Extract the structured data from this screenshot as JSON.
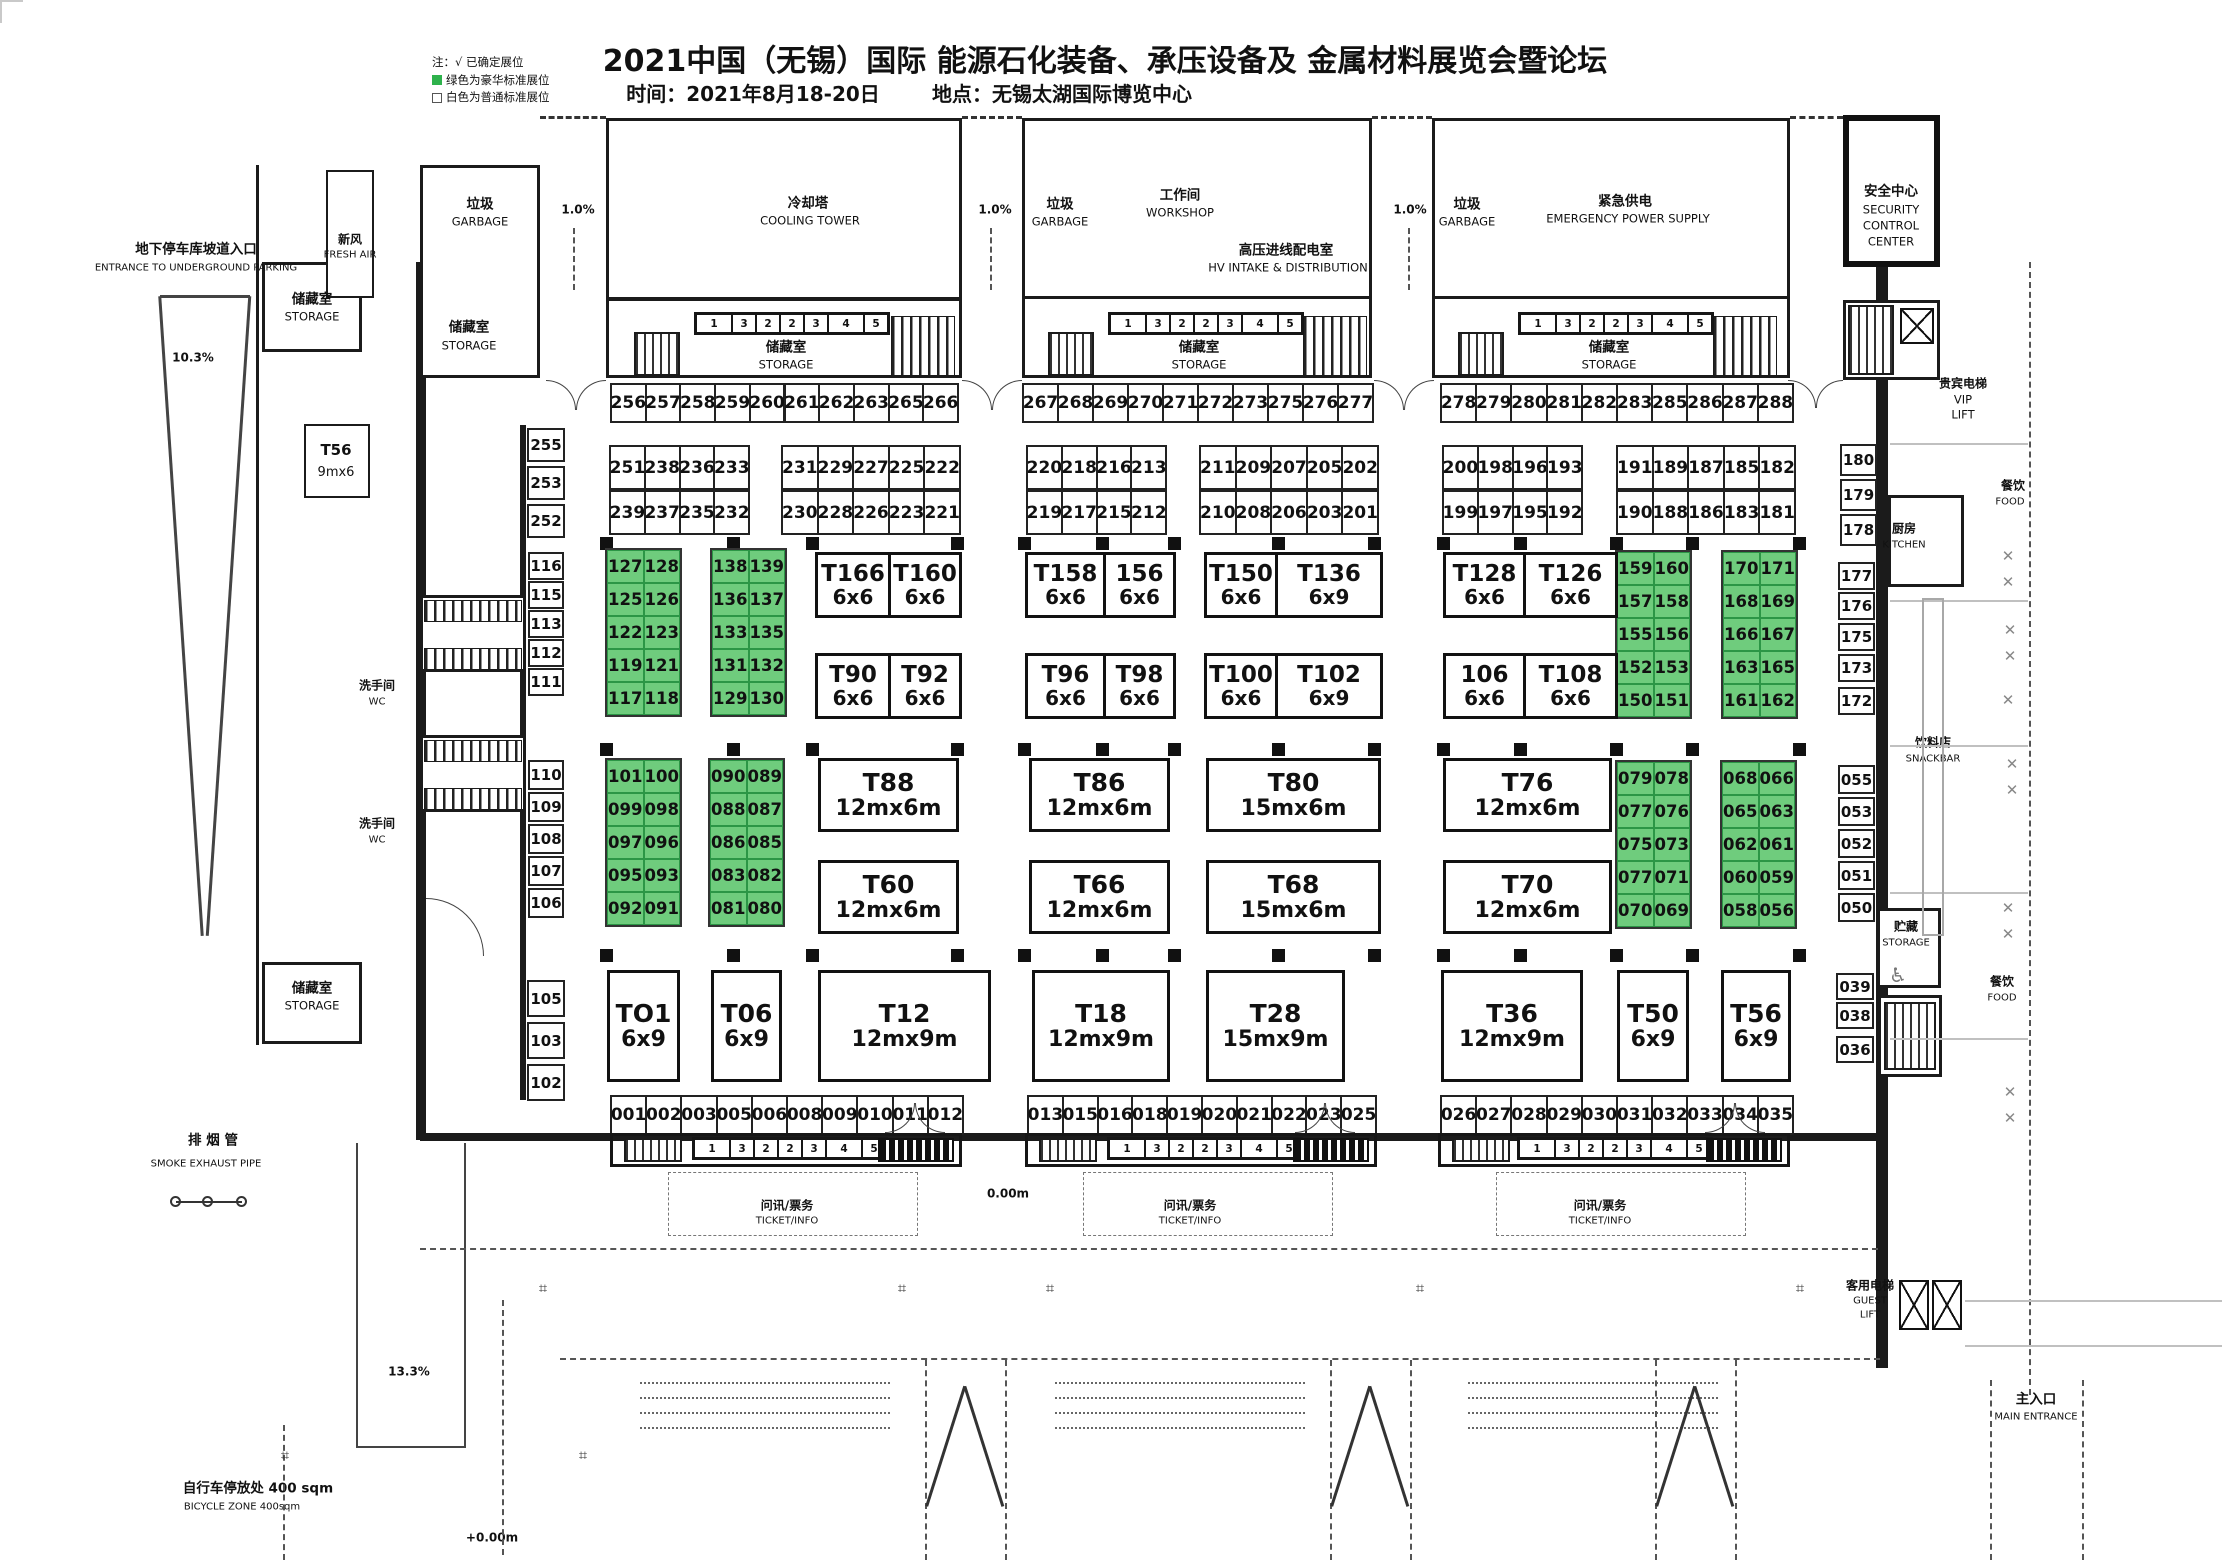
{
  "header": {
    "title": "2021中国（无锡）国际 能源石化装备、承压设备及 金属材料展览会暨论坛",
    "date_label": "时间：2021年8月18-20日",
    "venue_label": "地点：无锡太湖国际博览中心",
    "legend": {
      "note": "注：√ 已确定展位",
      "green": "绿色为豪华标准展位",
      "white": "白色为普通标准展位"
    }
  },
  "colors": {
    "green": "#6fcc7d",
    "green_border": "#2c9646",
    "wall": "#1b1b1b"
  },
  "facility": {
    "parking_zh": "地下停车库坡道入口",
    "parking_en": "ENTRANCE TO UNDERGROUND PARKING",
    "fresh_zh": "新风",
    "fresh_en": "FRESH AIR",
    "garbage_zh": "垃圾",
    "garbage_en": "GARBAGE",
    "cooling_zh": "冷却塔",
    "cooling_en": "COOLING TOWER",
    "workshop_zh": "工作间",
    "workshop_en": "WORKSHOP",
    "hv_zh": "高压进线配电室",
    "hv_en": "HV INTAKE & DISTRIBUTION",
    "emergency_zh": "紧急供电",
    "emergency_en": "EMERGENCY POWER SUPPLY",
    "security_zh": "安全中心",
    "security_en1": "SECURITY",
    "security_en2": "CONTROL",
    "security_en3": "CENTER",
    "storage_zh": "储藏室",
    "storage_en": "STORAGE",
    "storage2_zh": "贮藏",
    "vip_zh": "贵宾电梯",
    "vip_en1": "VIP",
    "vip_en2": "LIFT",
    "kitchen_zh": "厨房",
    "kitchen_en": "KITCHEN",
    "food_zh": "餐饮",
    "food_en": "FOOD",
    "snack_zh": "饮料店",
    "snack_en": "SNACKBAR",
    "guest_zh": "客用电梯",
    "guest_en1": "GUEST",
    "guest_en2": "LIFT",
    "main_zh": "主入口",
    "main_en": "MAIN ENTRANCE",
    "wc_zh": "洗手间",
    "wc_en": "WC",
    "ticket_zh": "问讯/票务",
    "ticket_en": "TICKET/INFO",
    "smoke_zh": "排 烟 管",
    "smoke_en": "SMOKE EXHAUST PIPE",
    "bike_zh": "自行车停放处  400  sqm",
    "bike_en": "BICYCLE ZONE 400sqm",
    "t56_label": "T56",
    "t56_size": "9mx6",
    "ramp_pct": "1.0%",
    "pct103": "10.3%",
    "pct133": "13.3%",
    "elev": "+0.00m",
    "elev0": "0.00m"
  },
  "booths": {
    "mini": [
      "1",
      "3",
      "2",
      "2",
      "3",
      "4",
      "5"
    ],
    "strip_top": [
      [
        "256",
        "257",
        "258",
        "259",
        "260",
        "261",
        "262",
        "263",
        "265",
        "266"
      ],
      [
        "267",
        "268",
        "269",
        "270",
        "271",
        "272",
        "273",
        "275",
        "276",
        "277"
      ],
      [
        "278",
        "279",
        "280",
        "281",
        "282",
        "283",
        "285",
        "286",
        "287",
        "288"
      ]
    ],
    "row2": {
      "left": [
        "255",
        "253",
        "252"
      ],
      "right": [
        "180",
        "179",
        "178"
      ],
      "groups": [
        {
          "top": [
            "251",
            "238",
            "236",
            "233"
          ],
          "bot": [
            "239",
            "237",
            "235",
            "232"
          ]
        },
        {
          "top": [
            "231",
            "229",
            "227",
            "225",
            "222"
          ],
          "bot": [
            "230",
            "228",
            "226",
            "223",
            "221"
          ]
        },
        {
          "top": [
            "220",
            "218",
            "216",
            "213"
          ],
          "bot": [
            "219",
            "217",
            "215",
            "212"
          ]
        },
        {
          "top": [
            "211",
            "209",
            "207",
            "205",
            "202"
          ],
          "bot": [
            "210",
            "208",
            "206",
            "203",
            "201"
          ]
        },
        {
          "top": [
            "200",
            "198",
            "196",
            "193"
          ],
          "bot": [
            "199",
            "197",
            "195",
            "192"
          ]
        },
        {
          "top": [
            "191",
            "189",
            "187",
            "185",
            "182"
          ],
          "bot": [
            "190",
            "188",
            "186",
            "183",
            "181"
          ]
        }
      ]
    },
    "band1": {
      "left": [
        "116",
        "115",
        "113",
        "112",
        "111"
      ],
      "right": [
        "177",
        "176",
        "175",
        "173",
        "172"
      ],
      "greens": [
        [
          [
            "127",
            "128"
          ],
          [
            "125",
            "126"
          ],
          [
            "122",
            "123"
          ],
          [
            "119",
            "121"
          ],
          [
            "117",
            "118"
          ]
        ],
        [
          [
            "138",
            "139"
          ],
          [
            "136",
            "137"
          ],
          [
            "133",
            "135"
          ],
          [
            "131",
            "132"
          ],
          [
            "129",
            "130"
          ]
        ],
        [
          [
            "159",
            "160"
          ],
          [
            "157",
            "158"
          ],
          [
            "155",
            "156"
          ],
          [
            "152",
            "153"
          ],
          [
            "150",
            "151"
          ]
        ],
        [
          [
            "170",
            "171"
          ],
          [
            "168",
            "169"
          ],
          [
            "166",
            "167"
          ],
          [
            "163",
            "165"
          ],
          [
            "161",
            "162"
          ]
        ]
      ],
      "pairs_top": [
        [
          [
            "T166",
            "6x6"
          ],
          [
            "T160",
            "6x6"
          ]
        ],
        [
          [
            "T158",
            "6x6"
          ],
          [
            "156",
            "6x6"
          ]
        ],
        [
          [
            "T150",
            "6x6"
          ],
          [
            "T136",
            "6x9"
          ]
        ],
        [
          [
            "T128",
            "6x6"
          ],
          [
            "T126",
            "6x6"
          ]
        ]
      ],
      "pairs_bot": [
        [
          [
            "T90",
            "6x6"
          ],
          [
            "T92",
            "6x6"
          ]
        ],
        [
          [
            "T96",
            "6x6"
          ],
          [
            "T98",
            "6x6"
          ]
        ],
        [
          [
            "T100",
            "6x6"
          ],
          [
            "T102",
            "6x9"
          ]
        ],
        [
          [
            "106",
            "6x6"
          ],
          [
            "T108",
            "6x6"
          ]
        ]
      ]
    },
    "band2": {
      "left": [
        "110",
        "109",
        "108",
        "107",
        "106"
      ],
      "right": [
        "055",
        "053",
        "052",
        "051",
        "050"
      ],
      "greens": [
        [
          [
            "101",
            "100"
          ],
          [
            "099",
            "098"
          ],
          [
            "097",
            "096"
          ],
          [
            "095",
            "093"
          ],
          [
            "092",
            "091"
          ]
        ],
        [
          [
            "090",
            "089"
          ],
          [
            "088",
            "087"
          ],
          [
            "086",
            "085"
          ],
          [
            "083",
            "082"
          ],
          [
            "081",
            "080"
          ]
        ],
        [
          [
            "079",
            "078"
          ],
          [
            "077",
            "076"
          ],
          [
            "075",
            "073"
          ],
          [
            "077",
            "071"
          ],
          [
            "070",
            "069"
          ]
        ],
        [
          [
            "068",
            "066"
          ],
          [
            "065",
            "063"
          ],
          [
            "062",
            "061"
          ],
          [
            "060",
            "059"
          ],
          [
            "058",
            "056"
          ]
        ]
      ],
      "top": [
        [
          "T88",
          "12mx6m"
        ],
        [
          "T86",
          "12mx6m"
        ],
        [
          "T80",
          "15mx6m"
        ],
        [
          "T76",
          "12mx6m"
        ]
      ],
      "bot": [
        [
          "T60",
          "12mx6m"
        ],
        [
          "T66",
          "12mx6m"
        ],
        [
          "T68",
          "15mx6m"
        ],
        [
          "T70",
          "12mx6m"
        ]
      ]
    },
    "band3": {
      "left": [
        "105",
        "103",
        "102"
      ],
      "right": [
        "039",
        "038",
        "036"
      ],
      "booths": [
        [
          "TO1",
          "6x9"
        ],
        [
          "T06",
          "6x9"
        ],
        [
          "T12",
          "12mx9m"
        ],
        [
          "T18",
          "12mx9m"
        ],
        [
          "T28",
          "15mx9m"
        ],
        [
          "T36",
          "12mx9m"
        ],
        [
          "T50",
          "6x9"
        ],
        [
          "T56",
          "6x9"
        ]
      ]
    },
    "strip_bottom": [
      [
        "001",
        "002",
        "003",
        "005",
        "006",
        "008",
        "009",
        "010",
        "011",
        "012"
      ],
      [
        "013",
        "015",
        "016",
        "018",
        "019",
        "020",
        "021",
        "022",
        "023",
        "025"
      ],
      [
        "026",
        "027",
        "028",
        "029",
        "030",
        "031",
        "032",
        "033",
        "034",
        "035"
      ]
    ]
  }
}
